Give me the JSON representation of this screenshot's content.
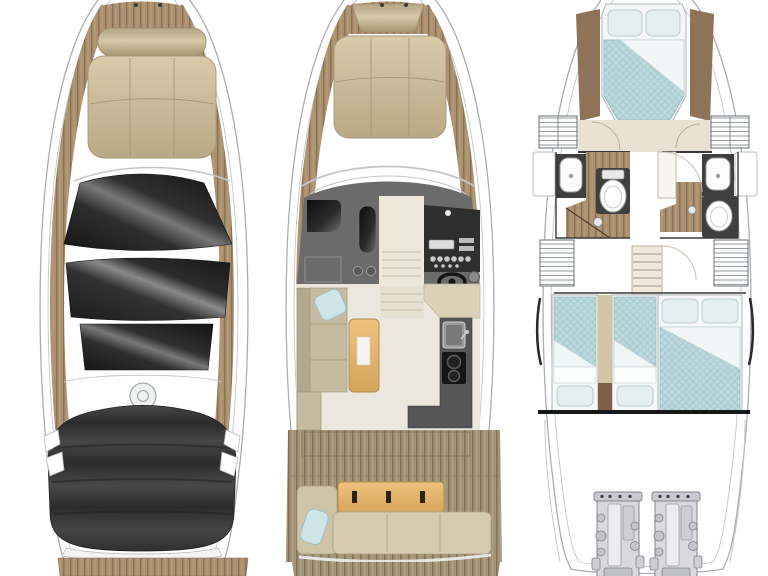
{
  "figure": {
    "type": "yacht-floorplan-three-views",
    "background": "#ffffff",
    "views": [
      {
        "id": "exterior-top-view",
        "position": "left",
        "features": [
          "bow-sunpad",
          "sunpad-backrest",
          "windshield-glass",
          "sunroof-panel",
          "cabin-skylight",
          "radar-dome",
          "cockpit-canvas-cover",
          "side-teak-decks",
          "swim-platform"
        ]
      },
      {
        "id": "main-deck-plan",
        "position": "center",
        "features": [
          "bow-sunpad",
          "anchor-locker",
          "windshield",
          "helm-seat",
          "copilot-seat",
          "helm-console",
          "steering-wheel",
          "companionway-steps",
          "dinette-sofa",
          "dinette-table",
          "galley-sink",
          "galley-cooktop",
          "galley-counter",
          "cockpit-sofa",
          "cockpit-table",
          "swim-platform"
        ]
      },
      {
        "id": "lower-deck-plan",
        "position": "right",
        "features": [
          "forward-cabin-bed",
          "wardrobes",
          "port-head-sink",
          "port-head-toilet",
          "port-shower",
          "starboard-head-sink",
          "starboard-head-toilet",
          "starboard-shower",
          "staircase",
          "port-twin-beds",
          "starboard-double-bed",
          "engine-room",
          "port-engine",
          "starboard-engine"
        ]
      }
    ]
  },
  "colors": {
    "background": "#ffffff",
    "hull_line": "#a9aeb2",
    "hull_inner_line": "#c3c7ca",
    "teak": "#ab9070",
    "teak_stripe": "#8c7156",
    "cushion_tan": "#cdbf9d",
    "glass_dark": "#1d1d1d",
    "canvas_dark": "#3a3a3a",
    "helm_floor": "#6b6b6b",
    "console_dark": "#2f2f2f",
    "salon_floor": "#ece7dc",
    "cabin_floor": "#e9e2d2",
    "wood_table": "#e2b469",
    "galley_counter": "#555555",
    "bedding_blue": "#bcd8dc",
    "pillow_blue": "#e6efef",
    "fixture_white": "#fcfcfc",
    "fixture_dark": "#3f3f3f",
    "engine_gray": "#d9d9dd",
    "wall_dark": "#3a3a3a",
    "wood_brown": "#8f7358",
    "sofa_beige": "#d6cab1"
  }
}
